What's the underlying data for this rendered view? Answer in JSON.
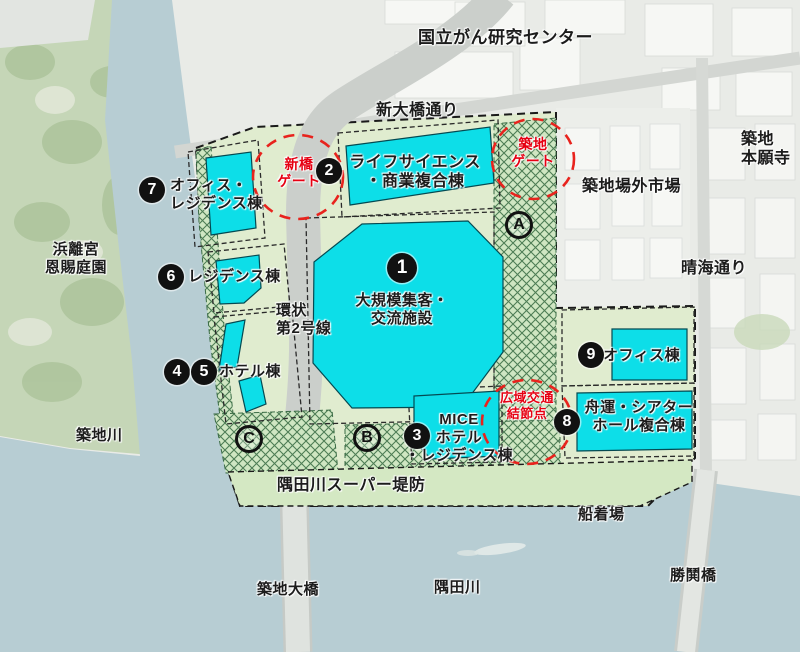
{
  "map_subject": "築地エリア再開発 土地利用イメージ",
  "colors": {
    "facility_cyan": "#0ddee8",
    "site_green": "#e0eccf",
    "hatch_green": "#cfe6c2",
    "hatch_line": "#4d7d55",
    "levee_green": "#d4e8c3",
    "water_blue": "#b7cdd3",
    "park_green": "#c5d6b7",
    "road_gray": "#cbcfcb",
    "gate_red": "#e60012",
    "badge_black": "#111111"
  },
  "labels": {
    "cancer_center": "国立がん研究センター",
    "shin_ohashi_dori": "新大橋通り",
    "tsukiji_honganji": "築地\n本願寺",
    "jogai_market": "築地場外市場",
    "harumi_dori": "晴海通り",
    "hamarikyu": "浜離宮\n恩賜庭園",
    "tsukiji_river": "築地川",
    "super_levee": "隅田川スーパー堤防",
    "boat_dock": "船着場",
    "tsukiji_bridge": "築地大橋",
    "sumida_river": "隅田川",
    "kachidoki_bridge": "勝鬨橋",
    "ring_road_2": "環状\n第2号線"
  },
  "gates": {
    "shimbashi": "新橋\nゲート",
    "tsukiji": "築地\nゲート",
    "transport_node": "広域交通\n結節点"
  },
  "facilities": {
    "f1": {
      "num": "1",
      "name": "大規模集客・\n交流施設"
    },
    "f2": {
      "num": "2",
      "name": "ライフサイエンス\n・商業複合棟"
    },
    "f3": {
      "num": "3",
      "name": "MICE\nホテル\n・レジデンス棟"
    },
    "f4": {
      "num": "4"
    },
    "f5": {
      "num": "5"
    },
    "f45_name": "ホテル棟",
    "f6": {
      "num": "6",
      "name": "レジデンス棟"
    },
    "f7": {
      "num": "7",
      "name": "オフィス・\nレジデンス棟"
    },
    "f8": {
      "num": "8",
      "name": "舟運・シアター\nホール複合棟"
    },
    "f9": {
      "num": "9",
      "name": "オフィス棟"
    }
  },
  "zones": {
    "a": "A",
    "b": "B",
    "c": "C"
  }
}
